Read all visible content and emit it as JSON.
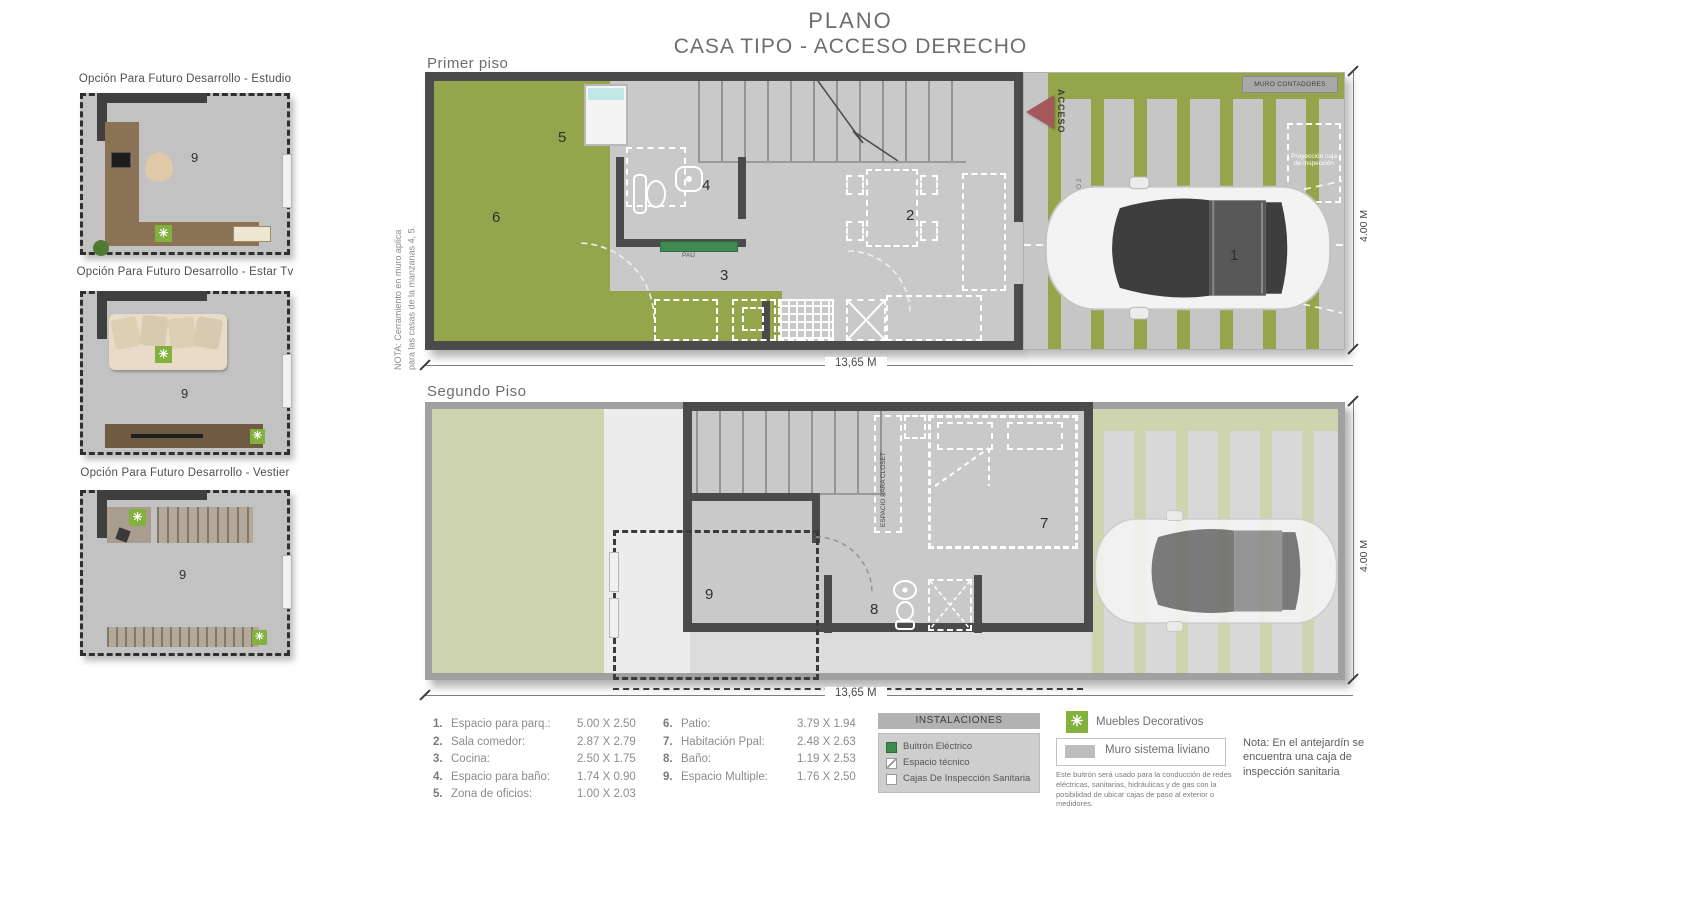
{
  "title": {
    "line1": "PLANO",
    "line2": "CASA TIPO -  ACCESO DERECHO"
  },
  "sidebar": {
    "options": [
      {
        "label": "Opción Para Futuro Desarrollo - Estudio",
        "room_number": "9"
      },
      {
        "label": "Opción Para Futuro Desarrollo - Estar Tv",
        "room_number": "9"
      },
      {
        "label": "Opción Para Futuro Desarrollo - Vestier",
        "room_number": "9"
      }
    ]
  },
  "first_floor": {
    "label": "Primer piso",
    "side_note_line1": "NOTA: Cerramiento  en muro aplica",
    "side_note_line2": "para las casas de la manzanas 4, 5.",
    "acceso_label": "ACCESO",
    "pau_label": "PAU",
    "muro_contadores_label": "MURO CONTADORES",
    "proyeccion_caja_label": "Proyección caja de inspección",
    "proyeccion_piso2_label": "PROYECCIÓN PISO 2",
    "rooms": {
      "parking": "1",
      "sala": "2",
      "cocina": "3",
      "bano": "4",
      "oficios": "5",
      "patio": "6"
    },
    "width_dim": "13,65 M",
    "height_dim": "4.00 M"
  },
  "second_floor": {
    "label": "Segundo Piso",
    "closet_label": "ESPACIO PARA CLOSET",
    "rooms": {
      "habitacion": "7",
      "bano": "8",
      "multiple": "9"
    },
    "width_dim": "13,65 M",
    "height_dim": "4.00 M"
  },
  "legend": {
    "spaces": [
      {
        "num": "1.",
        "name": "Espacio para parq.:",
        "dim": "5.00 X 2.50"
      },
      {
        "num": "2.",
        "name": "Sala comedor:",
        "dim": "2.87 X 2.79"
      },
      {
        "num": "3.",
        "name": "Cocina:",
        "dim": "2.50 X 1.75"
      },
      {
        "num": "4.",
        "name": "Espacio para baño:",
        "dim": "1.74 X 0.90"
      },
      {
        "num": "5.",
        "name": "Zona de oficios:",
        "dim": "1.00 X 2.03"
      },
      {
        "num": "6.",
        "name": "Patio:",
        "dim": "3.79 X 1.94"
      },
      {
        "num": "7.",
        "name": "Habitación Ppal:",
        "dim": "2.48 X 2.63"
      },
      {
        "num": "8.",
        "name": "Baño:",
        "dim": "1.19 X 2.53"
      },
      {
        "num": "9.",
        "name": "Espacio Multiple:",
        "dim": "1.76 X 2.50"
      }
    ],
    "instalaciones": {
      "header": "INSTALACIONES",
      "items": [
        {
          "label": "Buitrón Eléctrico"
        },
        {
          "label": "Espacio técnico"
        },
        {
          "label": "Cajas De Inspección Sanitaria"
        }
      ],
      "note": "Este buitrón será usado para la conducción de redes eléctricas, sanitarias, hidráulicas y de gas con la posibilidad de ubicar cajas de paso al exterior o medidores."
    },
    "muebles_label": "Muebles Decorativos",
    "muro_liviano_label": "Muro sistema liviano",
    "nota_antejardin": "Nota: En el antejardín se encuentra una caja de inspección sanitaria",
    "asterisk_glyph": "✳"
  },
  "colors": {
    "grass": "#94a54b",
    "grass_pale": "#ced4ad",
    "concrete": "#c9c9c9",
    "wall": "#4b4b4b",
    "acceso_red": "#a6575a",
    "buitron_green": "#3f8a50",
    "asterisk_green": "#82b13d"
  }
}
